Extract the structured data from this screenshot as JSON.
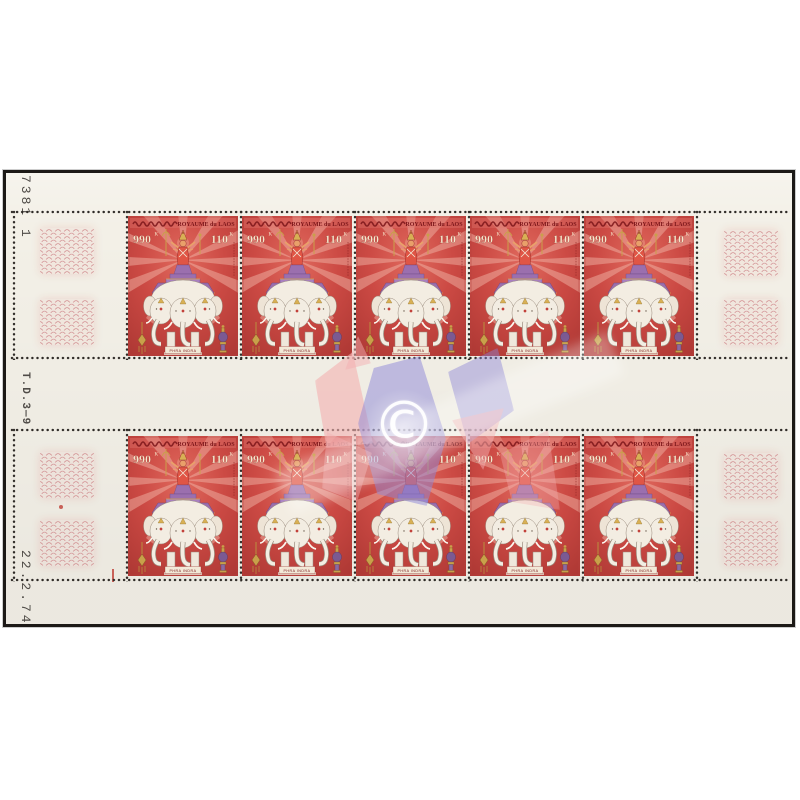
{
  "page": {
    "background_color": "#ffffff"
  },
  "sheet": {
    "paper_color": "#f3f0e7",
    "pane_count": 2,
    "stamps_per_pane": 5,
    "guilloche_color": "#cb7d82",
    "margin_marks": {
      "sheet_number": "7381 1",
      "press_mark": "T.D.3—9",
      "print_date": "22.2.74"
    }
  },
  "stamp": {
    "country_label": "ROYAUME du LAOS",
    "country_label_lao_script": "ພຣະຣາຊອານາຈັກລາວ",
    "value_lao_numerals": "990",
    "value_lao_suffix": "K",
    "denomination": "110",
    "denomination_suffix": "K",
    "caption": "PHRA INDRA",
    "colors": {
      "red": "#cc4a44",
      "ray_pink": "#f0b2a4",
      "purple": "#9b6fae",
      "gold": "#c9a04a",
      "cream_text": "#f6e8cd",
      "elephant_white": "#f3ede2",
      "dark_red_text": "#7c161a"
    }
  },
  "watermark": {
    "copyright_symbol": "©",
    "pink": "#f3b0b1",
    "blue": "#8b86d8"
  }
}
